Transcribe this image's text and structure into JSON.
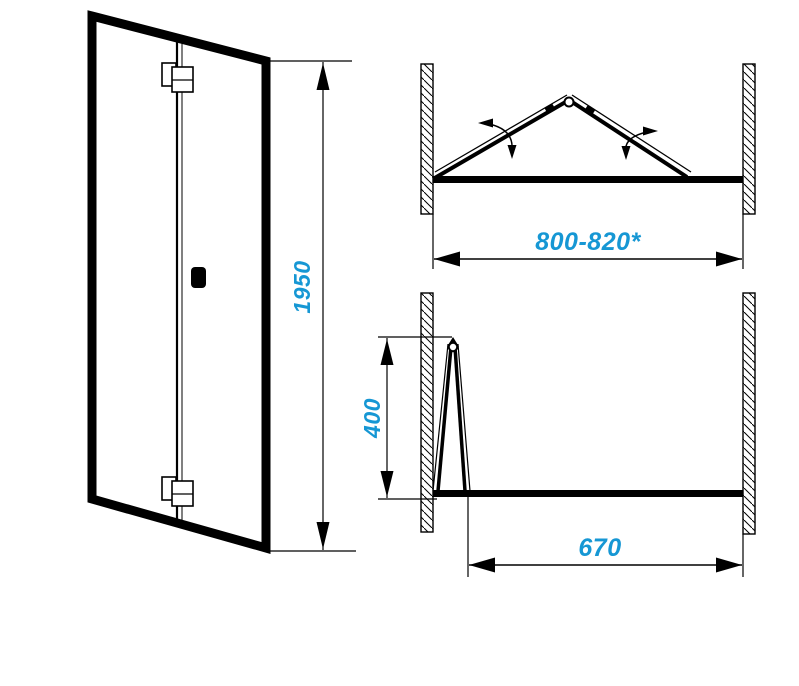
{
  "meta": {
    "title": "Folding shower door dimensional drawing"
  },
  "colors": {
    "dimension_text": "#1697D4",
    "line_color": "#000000"
  },
  "dimensions": {
    "door_height": "1950",
    "opening_width": "800-820*",
    "fold_depth": "400",
    "clear_width": "670"
  }
}
